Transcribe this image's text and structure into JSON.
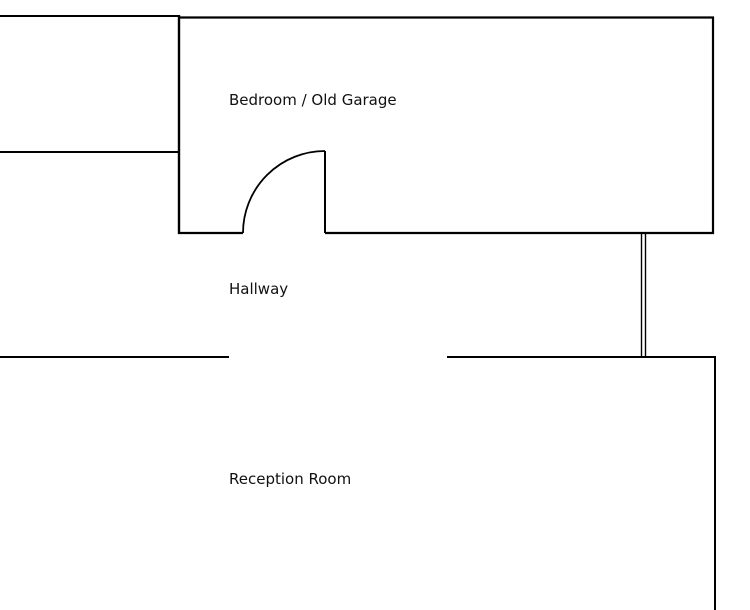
{
  "diagram": {
    "type": "floor-plan",
    "background": "#ffffff",
    "wall_color": "#000000",
    "text_color": "#111111",
    "rooms": [
      {
        "name": "bedroom-old-garage",
        "label": "Bedroom / Old Garage"
      },
      {
        "name": "hallway",
        "label": "Hallway"
      },
      {
        "name": "reception-room",
        "label": "Reception Room"
      }
    ],
    "walls": [
      {
        "name": "top-left-room-top-wall",
        "x1": 0,
        "y1": 16,
        "x2": 180,
        "y2": 16,
        "w": 2.0
      },
      {
        "name": "bedroom-top-wall",
        "x1": 178,
        "y1": 17.5,
        "x2": 714,
        "y2": 17.5,
        "w": 2.2
      },
      {
        "name": "top-left-room-bottom-wall",
        "x1": 0,
        "y1": 152,
        "x2": 180,
        "y2": 152,
        "w": 2.0
      },
      {
        "name": "bedroom-left-wall",
        "x1": 179,
        "y1": 15,
        "x2": 179,
        "y2": 234,
        "w": 2.4
      },
      {
        "name": "bedroom-right-wall",
        "x1": 713,
        "y1": 16.5,
        "x2": 713,
        "y2": 234,
        "w": 2.2
      },
      {
        "name": "bedroom-bottom-wall-left",
        "x1": 178,
        "y1": 233,
        "x2": 243,
        "y2": 233,
        "w": 2.2
      },
      {
        "name": "bedroom-bottom-wall-right",
        "x1": 325,
        "y1": 233,
        "x2": 714,
        "y2": 233,
        "w": 2.2
      },
      {
        "name": "hallway-partition-line-a",
        "x1": 641.5,
        "y1": 233,
        "x2": 641.5,
        "y2": 358,
        "w": 1.4
      },
      {
        "name": "hallway-partition-line-b",
        "x1": 645.5,
        "y1": 233,
        "x2": 645.5,
        "y2": 358,
        "w": 1.4
      },
      {
        "name": "hallway-bottom-wall-left",
        "x1": 0,
        "y1": 357,
        "x2": 229,
        "y2": 357,
        "w": 2.0
      },
      {
        "name": "hallway-bottom-wall-right",
        "x1": 447,
        "y1": 357,
        "x2": 716,
        "y2": 357,
        "w": 2.0
      },
      {
        "name": "reception-right-wall",
        "x1": 715,
        "y1": 356,
        "x2": 715,
        "y2": 610,
        "w": 2.0
      }
    ],
    "door": {
      "name": "bedroom-door",
      "leaf": {
        "x1": 325,
        "y1": 151,
        "x2": 325,
        "y2": 233,
        "w": 2.0
      },
      "arc": {
        "start_x": 243,
        "start_y": 233,
        "end_x": 325,
        "end_y": 151,
        "radius": 82,
        "w": 1.8
      }
    }
  }
}
